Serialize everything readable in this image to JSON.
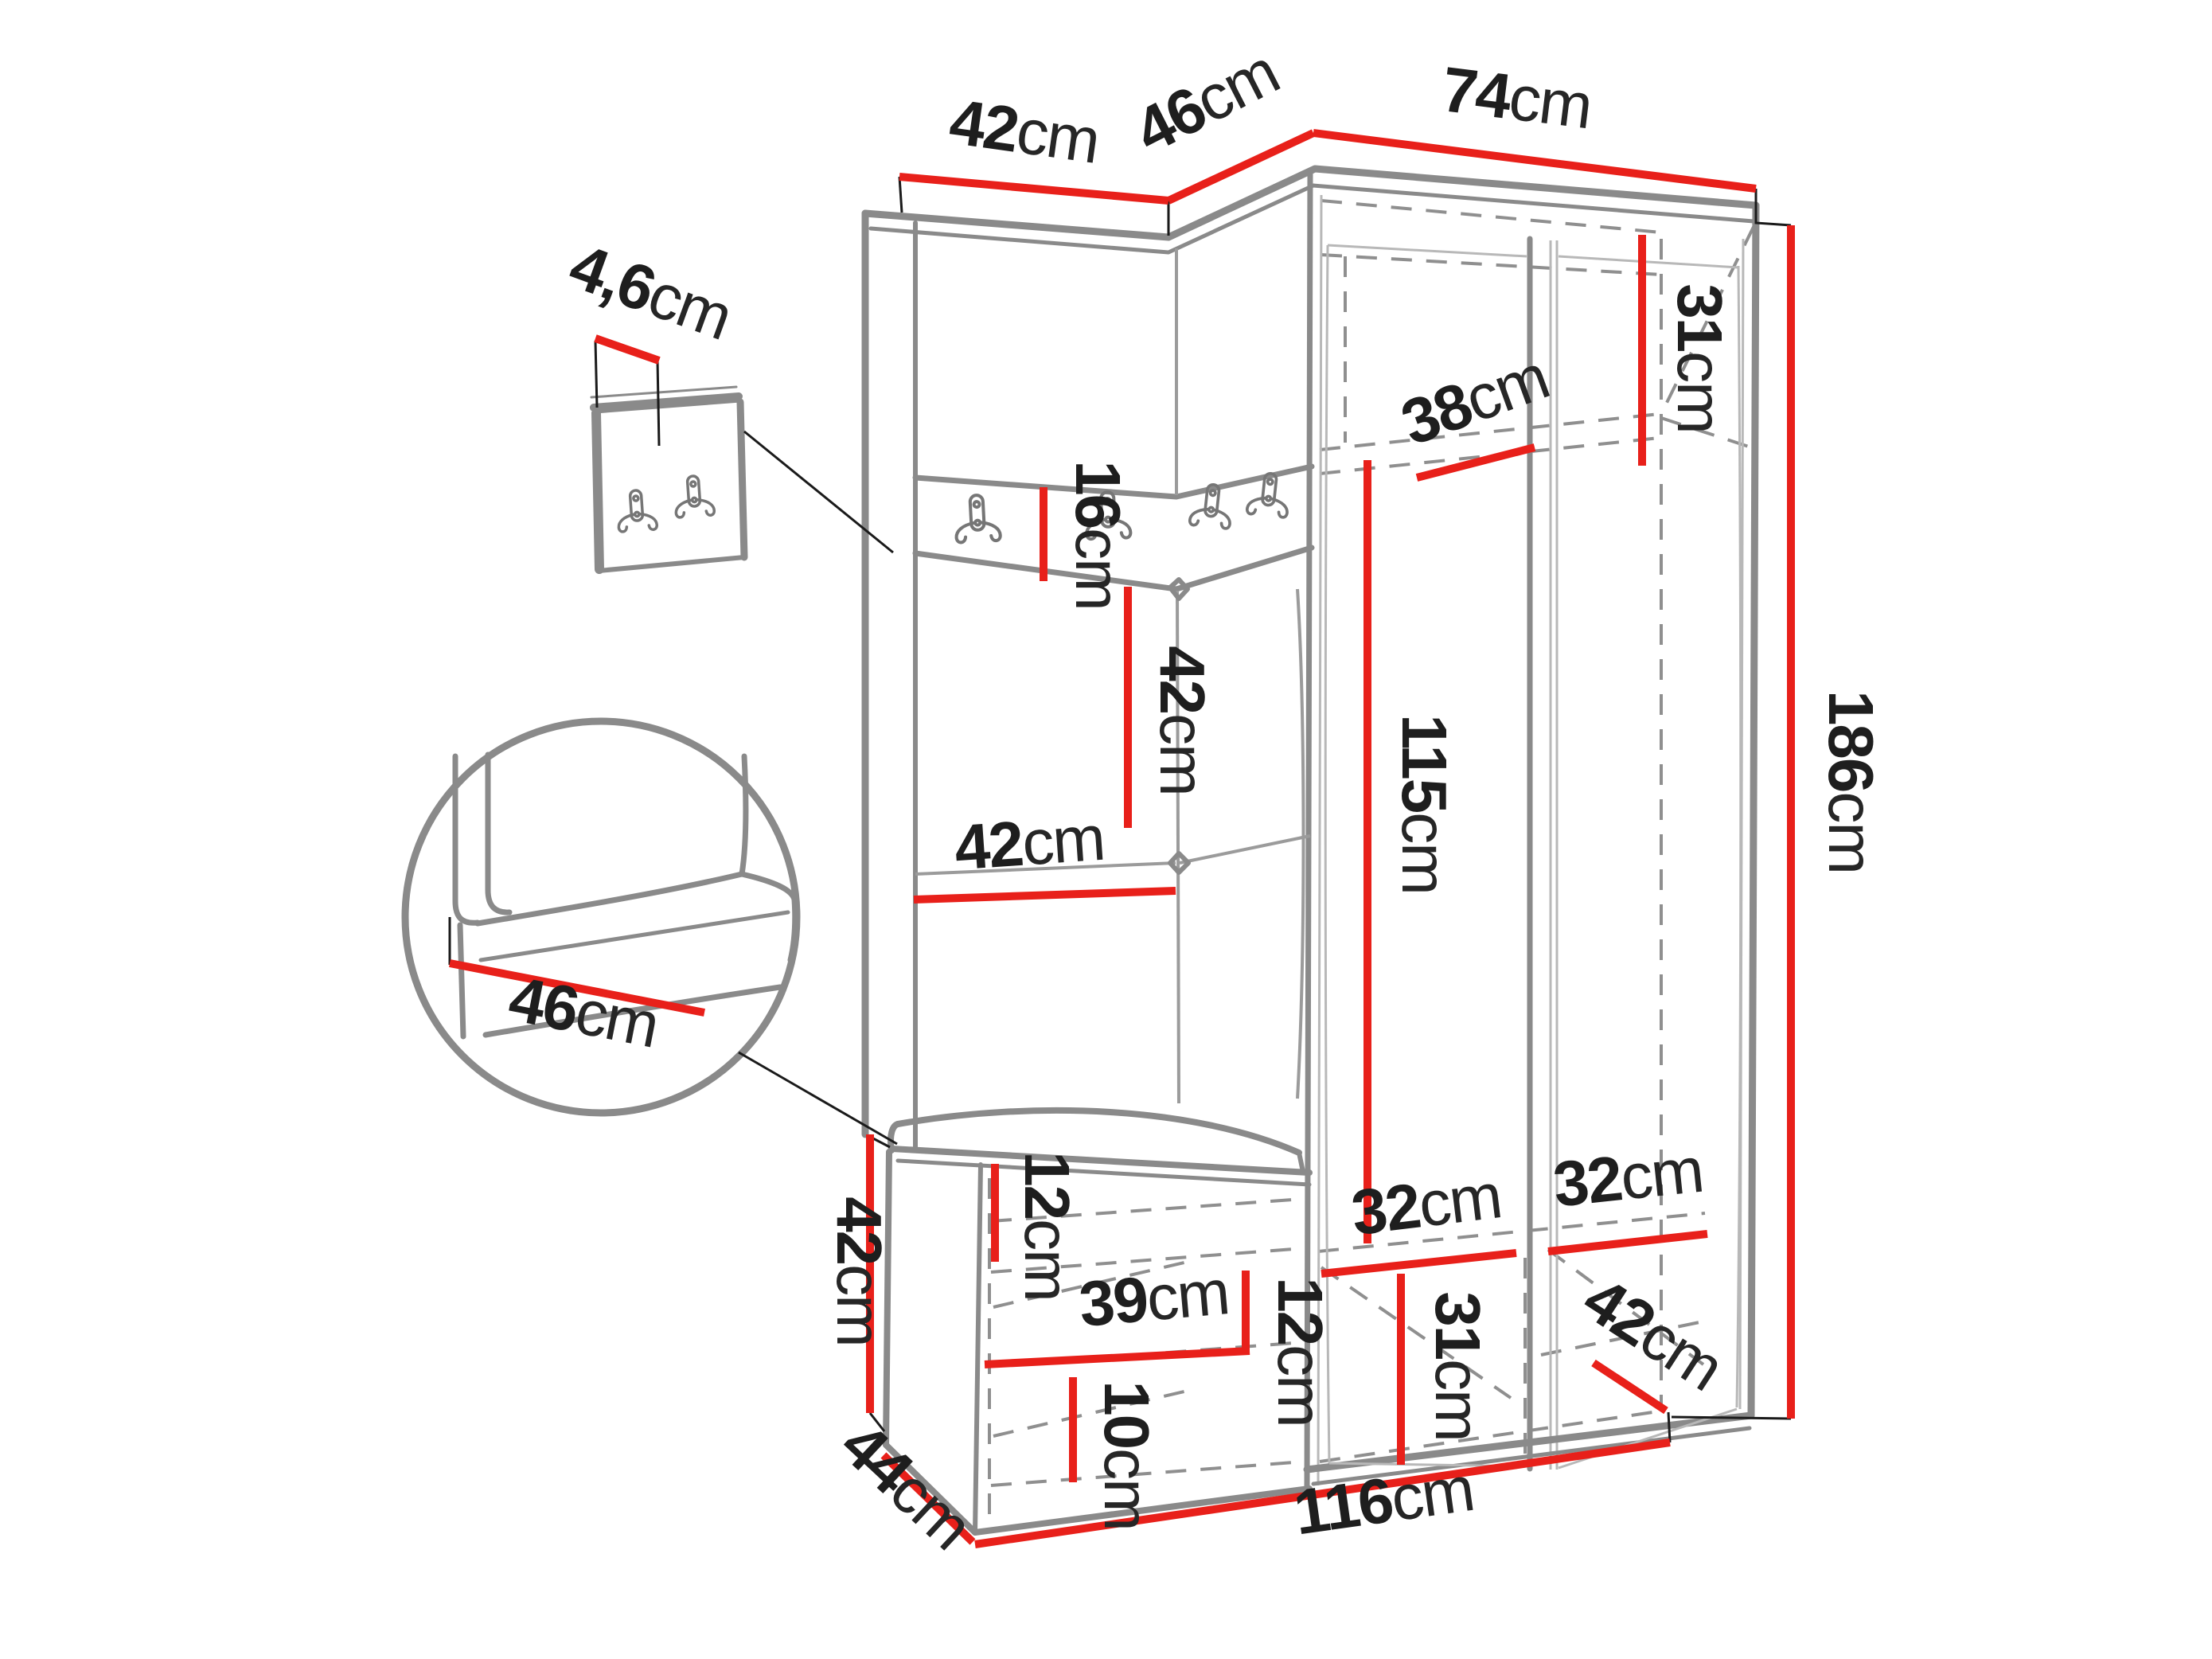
{
  "document": {
    "type": "furniture-dimension-diagram",
    "subject": "corner hallway wardrobe set with coat hooks, upholstered panels and shoe bench",
    "units": "cm",
    "background": "#ffffff"
  },
  "colors": {
    "dimension_line": "#e8201a",
    "outline": "#8a8a8a",
    "hidden_edge": "#8f8f8f",
    "label_text": "#1e1e1e",
    "leader_line": "#1a1a1a"
  },
  "icons": {
    "coat_hook": "double-coat-hook"
  },
  "dimensions": {
    "top_width_left": {
      "value": "42",
      "unit": "cm"
    },
    "top_width_corner": {
      "value": "46",
      "unit": "cm"
    },
    "top_width_right": {
      "value": "74",
      "unit": "cm"
    },
    "panel_thickness": {
      "value": "4,6",
      "unit": "cm"
    },
    "top_shelf_height": {
      "value": "31",
      "unit": "cm"
    },
    "top_shelf_depth": {
      "value": "38",
      "unit": "cm"
    },
    "hook_panel_height": {
      "value": "16",
      "unit": "cm"
    },
    "back_panel_height": {
      "value": "42",
      "unit": "cm"
    },
    "back_panel_width": {
      "value": "42",
      "unit": "cm"
    },
    "interior_height": {
      "value": "115",
      "unit": "cm"
    },
    "total_height": {
      "value": "186",
      "unit": "cm"
    },
    "seat_depth_detail": {
      "value": "46",
      "unit": "cm"
    },
    "bench_height": {
      "value": "42",
      "unit": "cm"
    },
    "bench_top_gap": {
      "value": "12",
      "unit": "cm"
    },
    "bench_shelf_width": {
      "value": "39",
      "unit": "cm"
    },
    "bench_shelf_gap": {
      "value": "12",
      "unit": "cm"
    },
    "bench_bottom_gap": {
      "value": "10",
      "unit": "cm"
    },
    "bench_depth": {
      "value": "44",
      "unit": "cm"
    },
    "compartment_left_width": {
      "value": "32",
      "unit": "cm"
    },
    "compartment_right_width": {
      "value": "32",
      "unit": "cm"
    },
    "compartment_bottom_height": {
      "value": "31",
      "unit": "cm"
    },
    "wardrobe_depth": {
      "value": "42",
      "unit": "cm"
    },
    "total_width": {
      "value": "116",
      "unit": "cm"
    }
  }
}
